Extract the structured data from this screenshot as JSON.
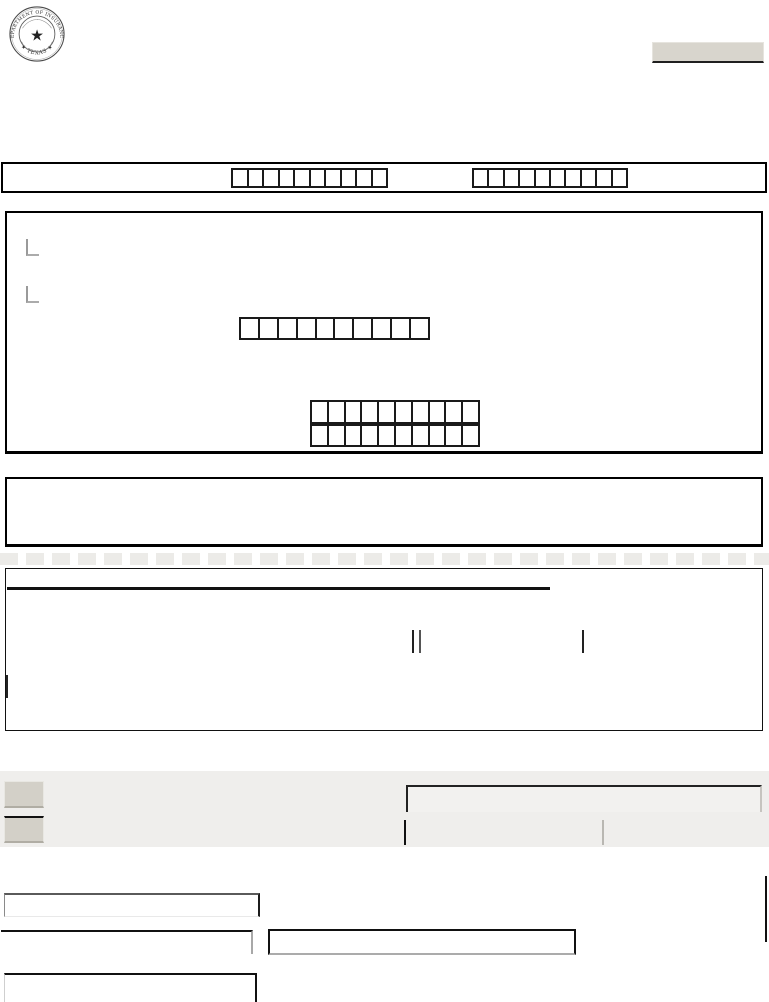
{
  "seal": {
    "ring_text_top": "DEPARTMENT OF INSURANCE",
    "ring_text_bottom": "★ TEXAS ★",
    "center_star": "★"
  },
  "colors": {
    "page_background": "#ffffff",
    "box_border": "#000000",
    "gray_band_background": "#efeeec",
    "header_button_fill": "#d8d5cd",
    "small_button_fill": "#d3d0c8",
    "comb_cell_border": "#1a1a1a"
  },
  "comb_fields": {
    "header_band_left": {
      "cells": 10
    },
    "header_band_right": {
      "cells": 10
    },
    "box1_upper": {
      "cells": 10
    },
    "box1_lower_row1": {
      "cells": 10
    },
    "box1_lower_row2": {
      "cells": 10
    }
  }
}
